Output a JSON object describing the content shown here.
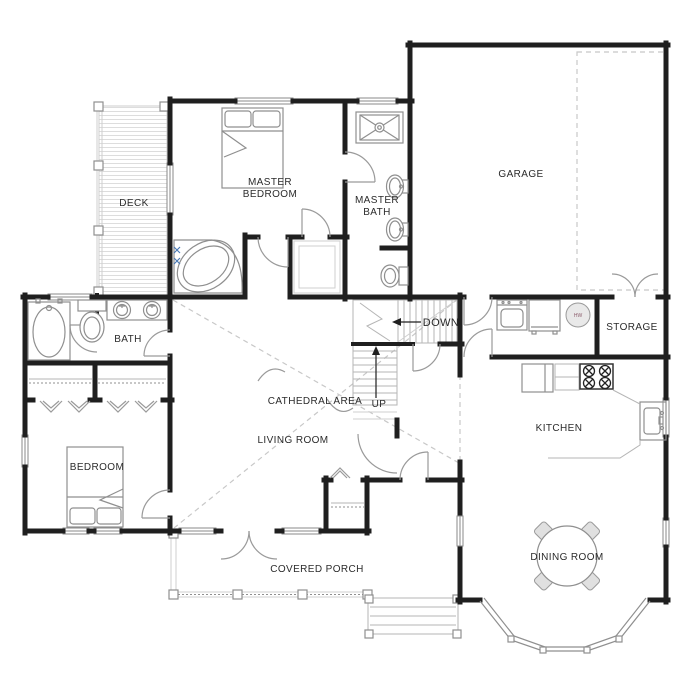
{
  "plan": {
    "labels": {
      "deck": "DECK",
      "master_bedroom": [
        "MASTER",
        "BEDROOM"
      ],
      "master_bath": [
        "MASTER",
        "BATH"
      ],
      "garage": "GARAGE",
      "stairs_down": "DOWN",
      "stairs_up": "UP",
      "storage": "STORAGE",
      "bath": "BATH",
      "cathedral_area": "CATHEDRAL AREA",
      "living_room": "LIVING ROOM",
      "bedroom": "BEDROOM",
      "covered_porch": "COVERED PORCH",
      "kitchen": "KITCHEN",
      "dining_room": "DINING ROOM",
      "water_heater": "HW"
    },
    "colors": {
      "wall": "#1f1f1f",
      "fixture_line": "#8f8f8f",
      "faint_line": "#cfcfcf",
      "label_text": "#2b2b2b",
      "faucet_accent": "#4a7ab5"
    }
  }
}
